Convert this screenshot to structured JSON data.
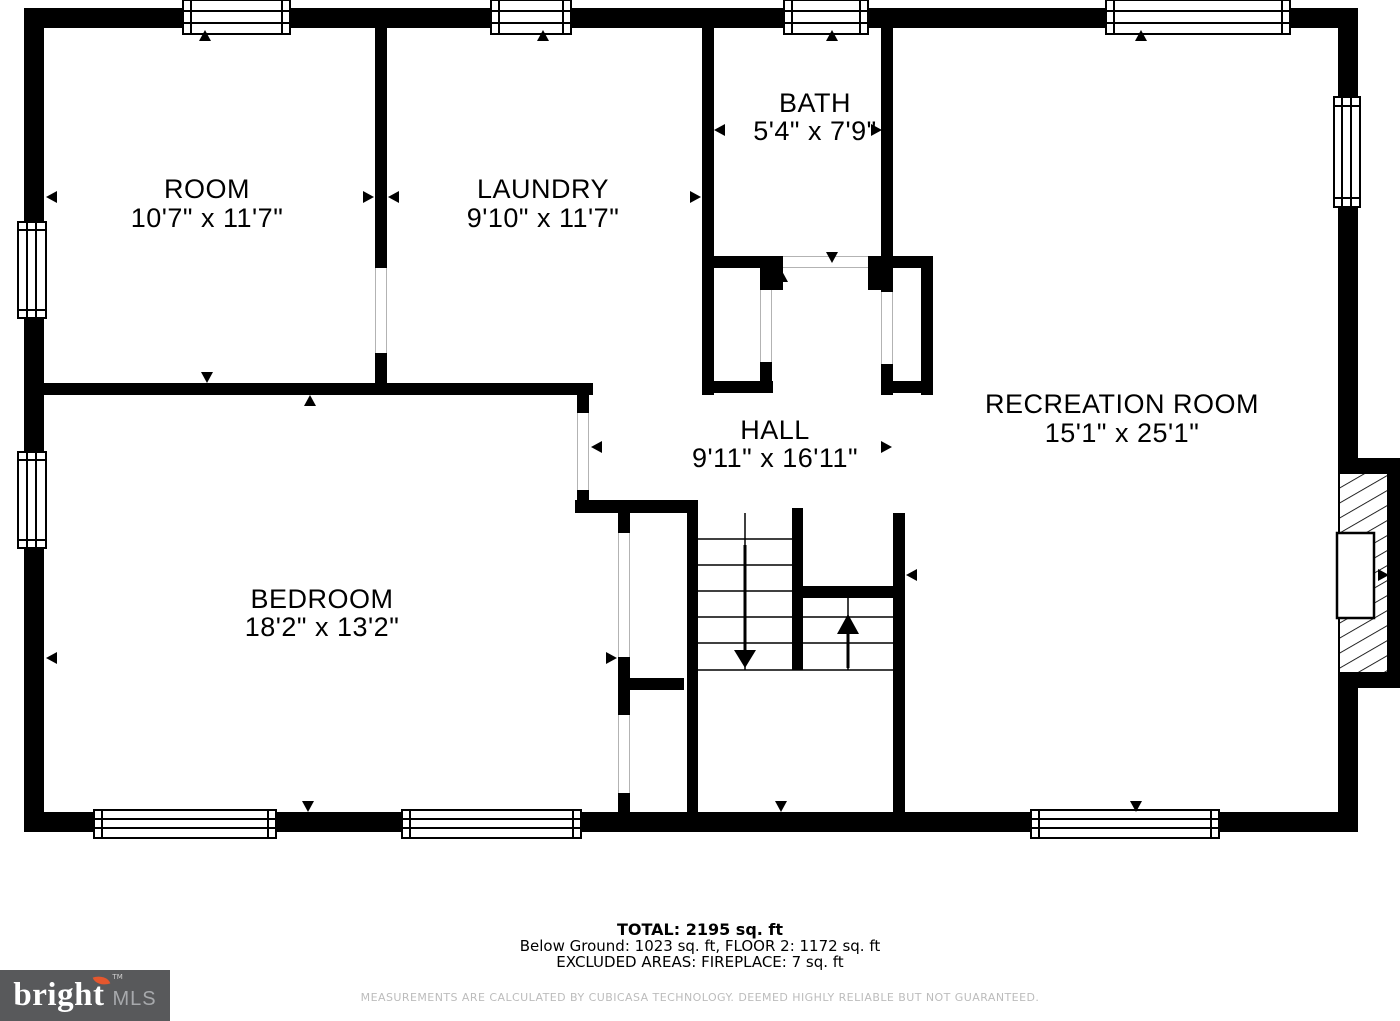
{
  "plan": {
    "wall_color": "#000000",
    "rooms": [
      {
        "id": "room",
        "name": "ROOM",
        "dims": "10'7\" x 11'7\""
      },
      {
        "id": "laundry",
        "name": "LAUNDRY",
        "dims": "9'10\" x 11'7\""
      },
      {
        "id": "bath",
        "name": "BATH",
        "dims": "5'4\" x 7'9\""
      },
      {
        "id": "recreation",
        "name": "RECREATION ROOM",
        "dims": "15'1\" x 25'1\""
      },
      {
        "id": "hall",
        "name": "HALL",
        "dims": "9'11\" x 16'11\""
      },
      {
        "id": "bedroom",
        "name": "BEDROOM",
        "dims": "18'2\" x 13'2\""
      }
    ]
  },
  "summary": {
    "total": "TOTAL: 2195 sq. ft",
    "breakdown": "Below Ground: 1023 sq. ft, FLOOR 2: 1172 sq. ft",
    "excluded": "EXCLUDED AREAS: FIREPLACE: 7 sq. ft"
  },
  "disclaimer": "MEASUREMENTS ARE CALCULATED BY CUBICASA TECHNOLOGY. DEEMED HIGHLY RELIABLE BUT NOT GUARANTEED.",
  "logo": {
    "brand": "bright",
    "tm": "TM",
    "suffix": "MLS",
    "box_color": "#58595b",
    "flame_color": "#e4572e"
  }
}
